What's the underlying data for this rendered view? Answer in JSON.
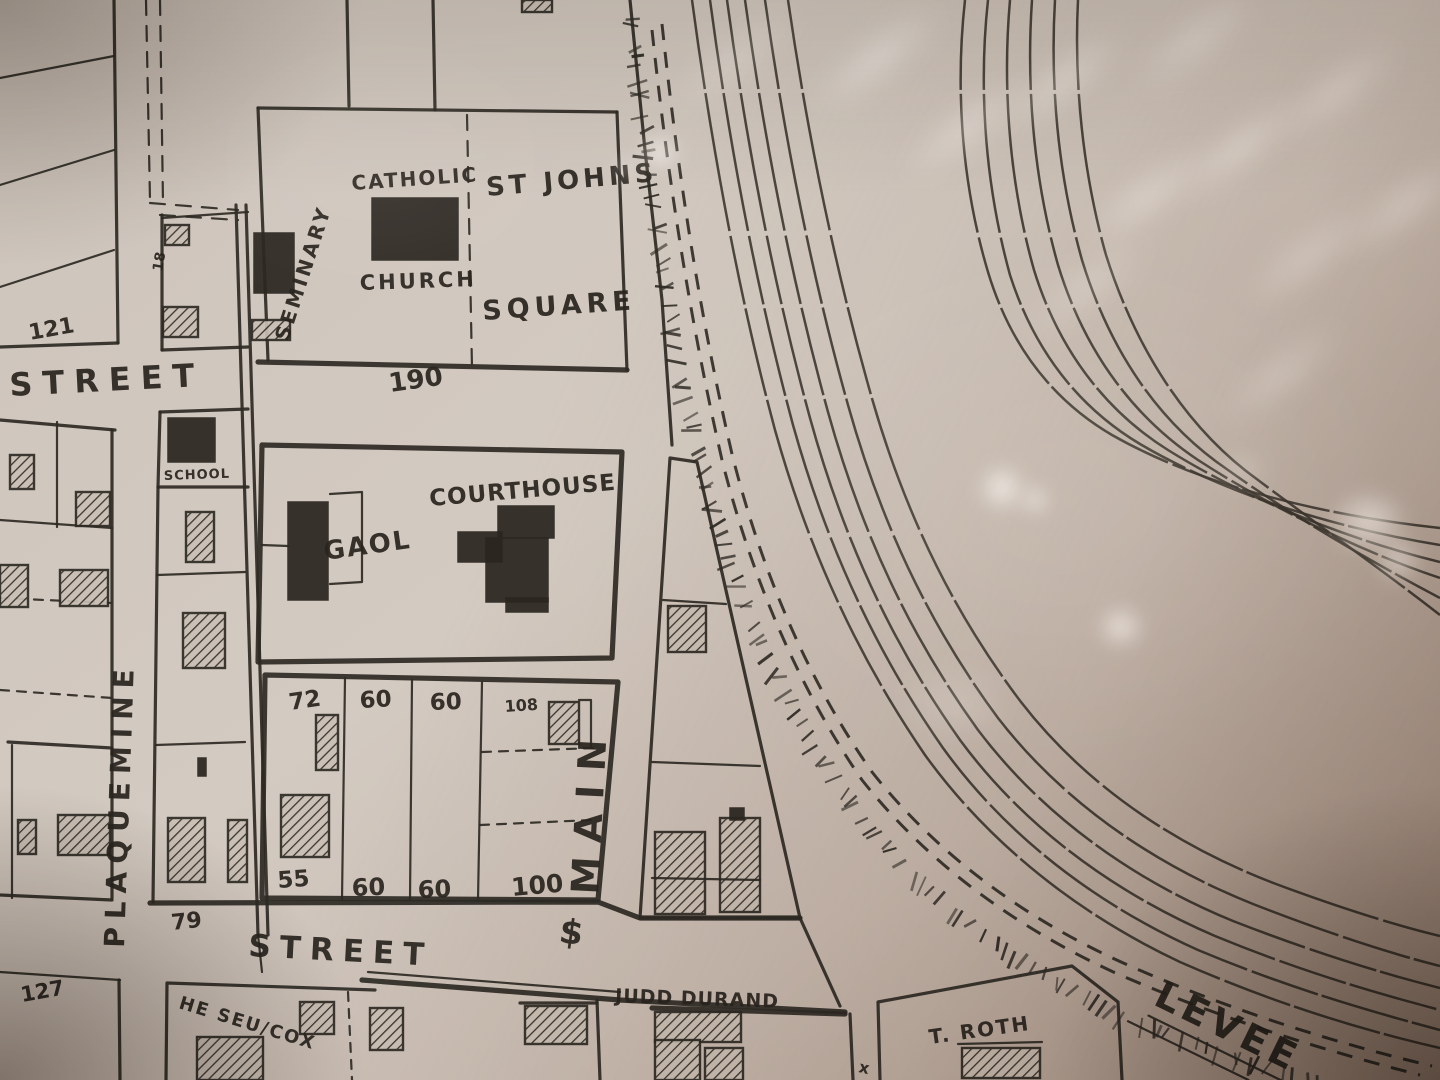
{
  "map": {
    "title": "hand-drawn town plat photographed under glass",
    "streets": {
      "plaquemine": "PLAQUEMINE",
      "main": "MAIN",
      "street_top_left": "STREET",
      "street_bottom": "STREET",
      "levee": "LEVEE"
    },
    "landmarks": {
      "catholic": "CATHOLIC",
      "church": "CHURCH",
      "st_johns": "ST JOHNS",
      "square": "SQUARE",
      "seminary": "SEMINARY",
      "school": "SCHOOL",
      "courthouse": "COURTHOUSE",
      "gaol": "GAOL"
    },
    "owners": {
      "judd_durand": "JUDD DURAND",
      "t_roth": "T. ROTH",
      "he_seu_cox": "HE SEU/COX"
    },
    "block_numbers": {
      "church_block": "190"
    },
    "lots": {
      "top_left": "121",
      "bottom_left": "127",
      "small": "18",
      "corner": "79",
      "row_top": [
        "72",
        "60",
        "60",
        "108"
      ],
      "row_bottom": [
        "55",
        "60",
        "60",
        "100"
      ]
    },
    "marks": {
      "section": "$",
      "x": "x"
    }
  },
  "colors": {
    "ink": "#2e2a24",
    "paper": "#cfc5ba",
    "paper_dark": "#a9968a",
    "glare": "#fff8ea"
  }
}
